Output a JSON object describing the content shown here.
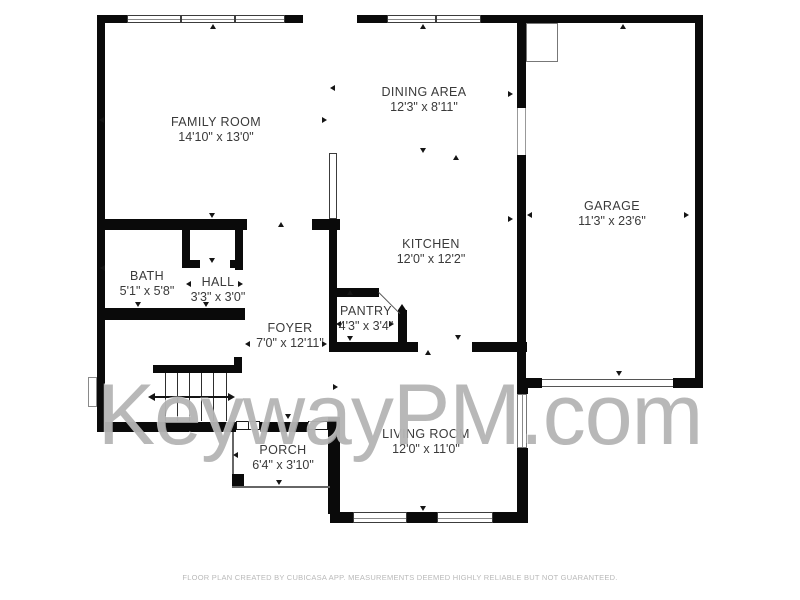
{
  "watermark": "KeywayPM.com",
  "footer": "FLOOR PLAN CREATED BY CUBICASA APP. MEASUREMENTS DEEMED HIGHLY RELIABLE BUT NOT GUARANTEED.",
  "colors": {
    "wall": "#0a0a0a",
    "label": "#3a3a3a",
    "watermark": "#acacac",
    "footer_text": "#b9b9b9",
    "background": "#ffffff"
  },
  "rooms": [
    {
      "id": "family-room",
      "name": "FAMILY ROOM",
      "dims": "14'10\" x 13'0\""
    },
    {
      "id": "dining-area",
      "name": "DINING AREA",
      "dims": "12'3\" x 8'11\""
    },
    {
      "id": "garage",
      "name": "GARAGE",
      "dims": "11'3\" x 23'6\""
    },
    {
      "id": "kitchen",
      "name": "KITCHEN",
      "dims": "12'0\" x 12'2\""
    },
    {
      "id": "bath",
      "name": "BATH",
      "dims": "5'1\" x 5'8\""
    },
    {
      "id": "hall",
      "name": "HALL",
      "dims": "3'3\" x 3'0\""
    },
    {
      "id": "foyer",
      "name": "FOYER",
      "dims": "7'0\" x 12'11\""
    },
    {
      "id": "pantry",
      "name": "PANTRY",
      "dims": "4'3\" x 3'4\""
    },
    {
      "id": "porch",
      "name": "PORCH",
      "dims": "6'4\" x 3'10\""
    },
    {
      "id": "living-room",
      "name": "LIVING ROOM",
      "dims": "12'0\" x 11'0\""
    }
  ]
}
